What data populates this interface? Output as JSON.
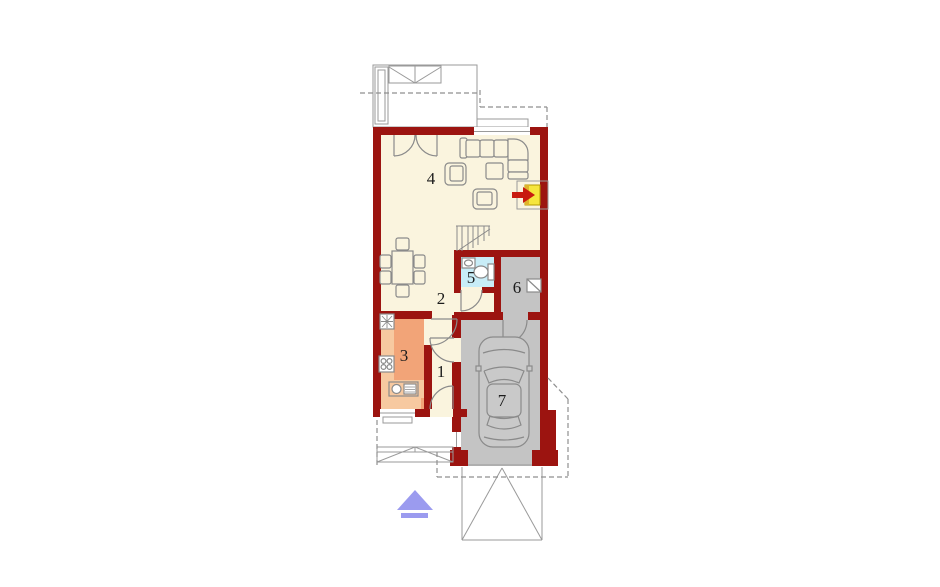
{
  "plan": {
    "type": "floor-plan",
    "rooms": {
      "r1": {
        "label": "1",
        "name": "entry-hall"
      },
      "r2": {
        "label": "2",
        "name": "hallway"
      },
      "r3": {
        "label": "3",
        "name": "kitchen"
      },
      "r4": {
        "label": "4",
        "name": "living-room"
      },
      "r5": {
        "label": "5",
        "name": "bathroom"
      },
      "r6": {
        "label": "6",
        "name": "utility-room"
      },
      "r7": {
        "label": "7",
        "name": "garage"
      }
    },
    "colors": {
      "wall": "#9C1410",
      "floor": "#FAF4DE",
      "kitchen": "#F2A478",
      "counter": "#F7C9A0",
      "bath": "#C8EDF7",
      "garage": "#C4C4C4",
      "car": "#C9C9C9",
      "fireplace": "#F6E63C",
      "fireplace_shade": "#E0B32A",
      "fireplace_arrow": "#C81B10",
      "entrance_arrow": "#9B9BEF",
      "white": "#FFFFFF"
    }
  }
}
